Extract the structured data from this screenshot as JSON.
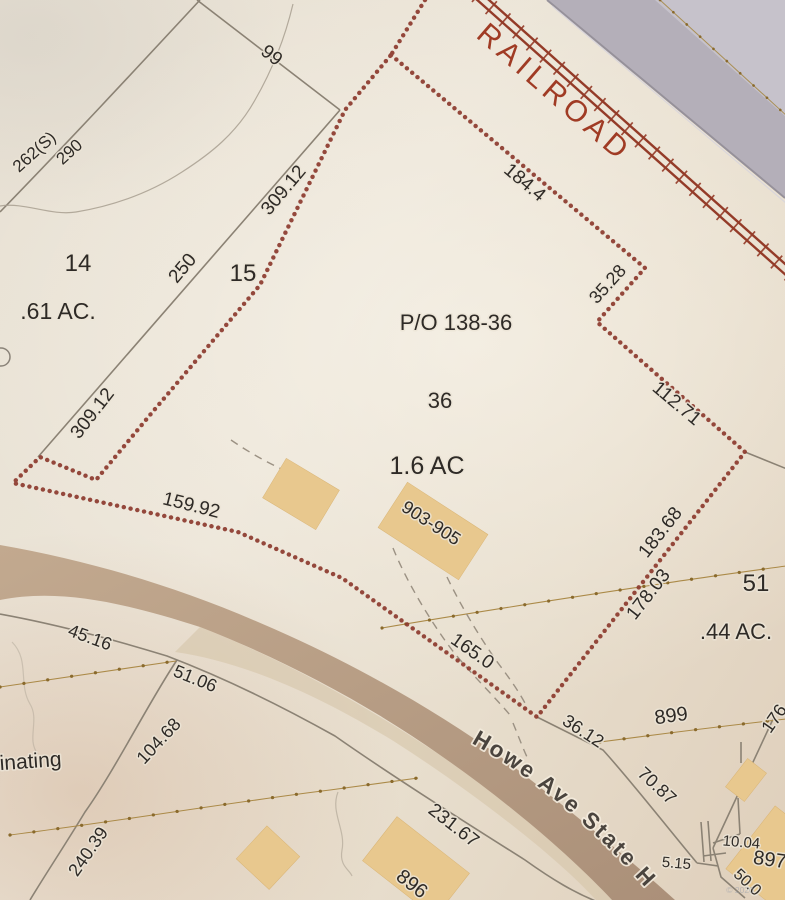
{
  "map": {
    "labels": {
      "railroad": "RAILROAD",
      "d184_4": "184.4",
      "d35_28": "35.28",
      "d112_71": "112.71",
      "d183_68": "183.68",
      "d178_03": "178.03",
      "d165_0": "165.0",
      "d159_92": "159.92",
      "d309_12a": "309.12",
      "d250": "250",
      "d309_12b": "309.12",
      "d99": "99",
      "l262s": "262(S)",
      "l290": "290",
      "lot14": "14",
      "area61": ".61 AC.",
      "lot15": "15",
      "po13836": "P/O 138-36",
      "lot36": "36",
      "area16": "1.6 AC",
      "b903905": "903-905",
      "lot51": "51",
      "area44": ".44 AC.",
      "d36_12": "36.12",
      "l899": "899",
      "d176": "176",
      "d70_87": "70.87",
      "d45_16": "45.16",
      "d51_06": "51.06",
      "d104_68": "104.68",
      "d240_39": "240.39",
      "inating": "inating",
      "d231_67": "231.67",
      "l896": "896",
      "l897": "897",
      "d10_04": "10.04",
      "d5_15": "5.15",
      "d50_0": "50.0",
      "street": "Howe Ave State H",
      "watermark": "© 2020"
    },
    "colors": {
      "parcel": "#8c3a2e",
      "railroad": "#a03b24",
      "survey": "#8b8274",
      "tan_line": "#ab8a48",
      "tan_dot": "#8a6a2c",
      "road": "#b29880",
      "building": "#e8c88e",
      "offmap": "#b4afb9",
      "label": "#2e2a26"
    }
  }
}
